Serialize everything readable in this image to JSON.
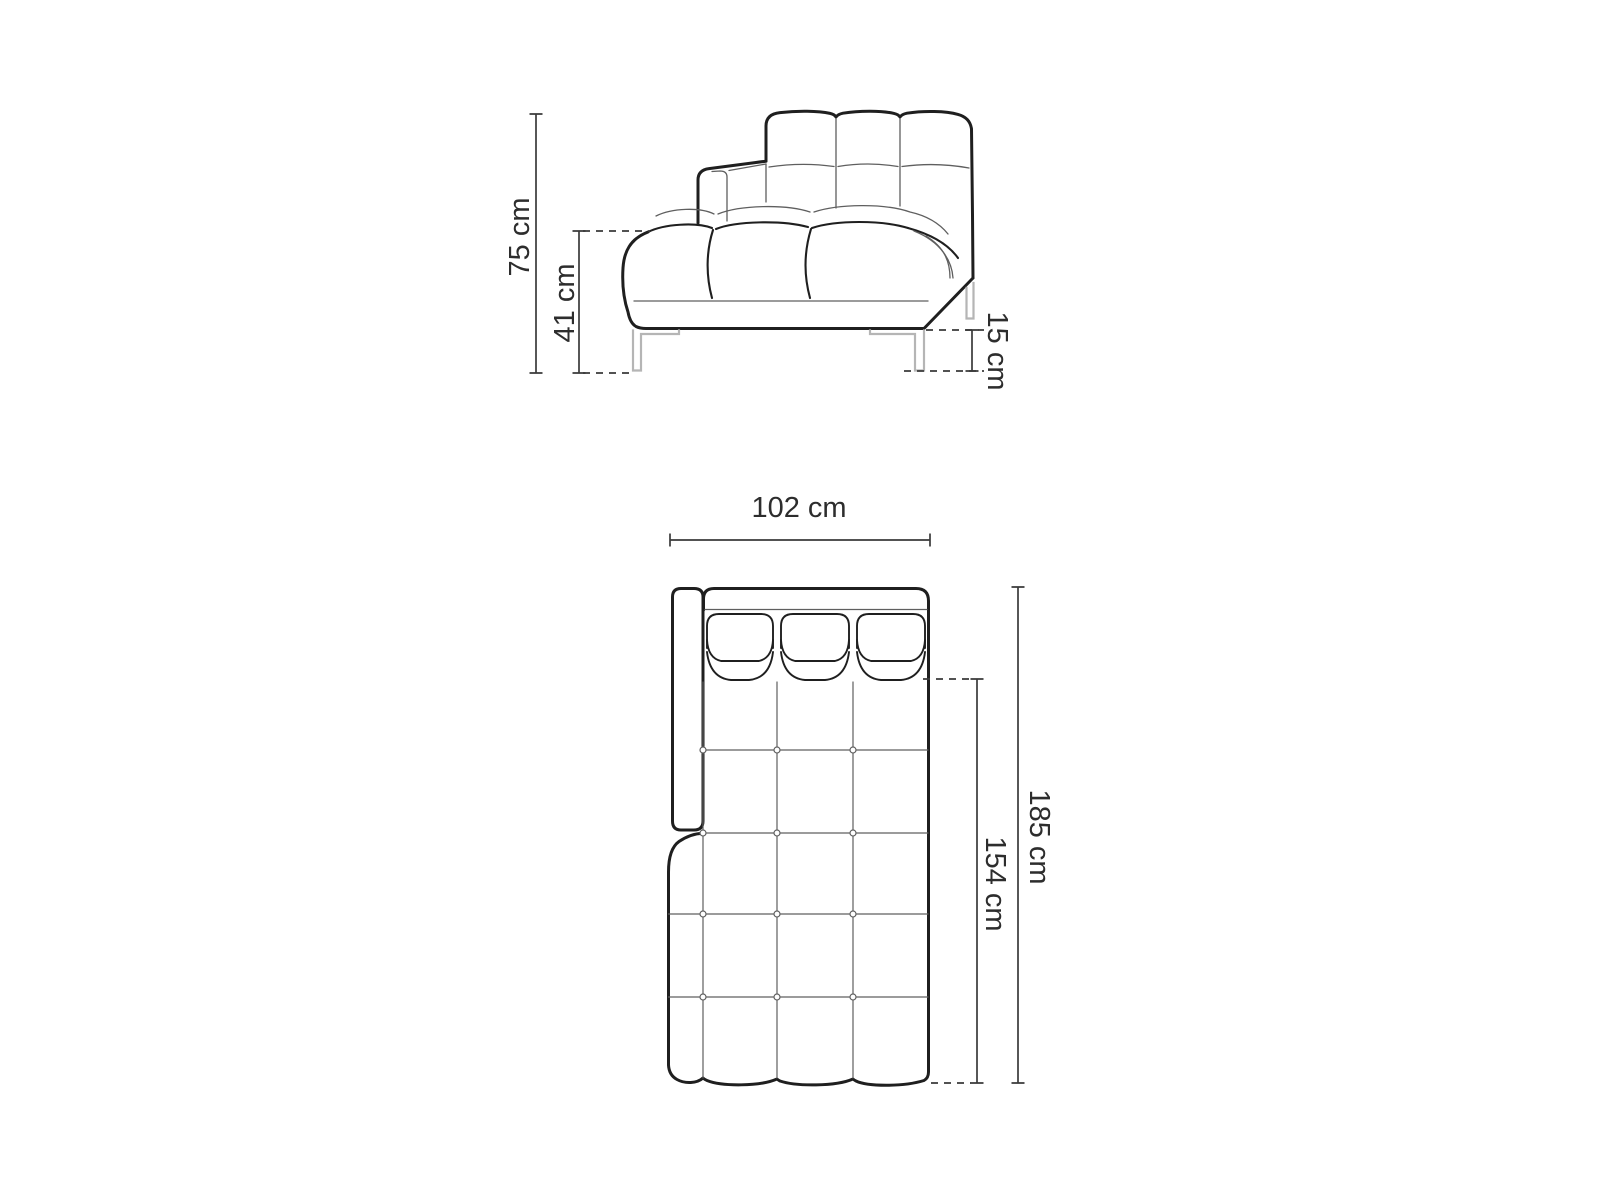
{
  "diagram_type": "furniture-dimension-drawing",
  "views": {
    "side_view": {
      "total_height": "75 cm",
      "seat_height": "41 cm",
      "leg_height": "15 cm"
    },
    "top_view": {
      "width": "102 cm",
      "total_length": "185 cm",
      "seat_length": "154 cm"
    }
  },
  "colors": {
    "background": "#ffffff",
    "outline": "#1f1f1f",
    "detail_line": "#5f5f5f",
    "dimension_line": "#3a3a3a",
    "leg_line": "#b5b5b5",
    "label_text": "#2d2d2d"
  }
}
